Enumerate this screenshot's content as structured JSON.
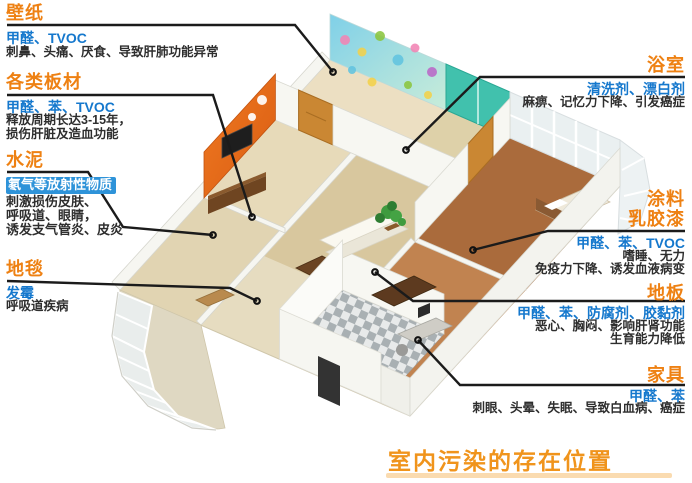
{
  "page": {
    "caption": "室内污染的存在位置"
  },
  "colors": {
    "title_orange": "#ee8113",
    "pollutant_blue": "#1578cd",
    "effect_dark": "#2e2e2e",
    "highlight_blue_bg": "#2e93d9",
    "callout_line": "#1b1b1b",
    "caption_orange": "#f0941c"
  },
  "callouts": {
    "left": [
      {
        "id": "wallpaper",
        "title": "壁纸",
        "pollutants": "甲醛、TVOC",
        "effects": [
          "刺鼻、头痛、厌食、导致肝肺功能异常"
        ]
      },
      {
        "id": "boards",
        "title": "各类板材",
        "pollutants": "甲醛、苯、TVOC",
        "effects": [
          "释放周期长达3-15年，",
          "损伤肝脏及造血功能"
        ]
      },
      {
        "id": "cement",
        "title": "水泥",
        "pollutants": "氡气等放射性物质",
        "pollutants_highlighted": true,
        "effects": [
          "刺激损伤皮肤、",
          "呼吸道、眼睛，",
          "诱发支气管炎、皮炎"
        ]
      },
      {
        "id": "carpet",
        "title": "地毯",
        "pollutants": "发霉",
        "effects": [
          "呼吸道疾病"
        ]
      }
    ],
    "right": [
      {
        "id": "bathroom",
        "title": "浴室",
        "pollutants": "清洗剂、漂白剂",
        "effects": [
          "麻痹、记忆力下降、引发癌症"
        ]
      },
      {
        "id": "paint",
        "title": "涂料",
        "title2": "乳胶漆",
        "pollutants": "甲醛、苯、TVOC",
        "effects": [
          "嗜睡、无力",
          "免疫力下降、诱发血液病变"
        ]
      },
      {
        "id": "floorboard",
        "title": "地板",
        "pollutants": "甲醛、苯、防腐剂、胶黏剂",
        "effects": [
          "恶心、胸闷、影响肝肾功能",
          "生育能力降低"
        ]
      },
      {
        "id": "furniture",
        "title": "家具",
        "pollutants": "甲醛、苯",
        "effects": [
          "刺眼、头晕、失眠、导致白血病、癌症"
        ]
      }
    ]
  },
  "house": {
    "type": "isometric-cutaway-apartment",
    "marked_spots": [
      "wallpaper-wall",
      "board-wall",
      "cement-wall",
      "living-room-carpet",
      "bathroom",
      "painted-bedroom-wall",
      "wood-floor",
      "study-furniture"
    ]
  }
}
